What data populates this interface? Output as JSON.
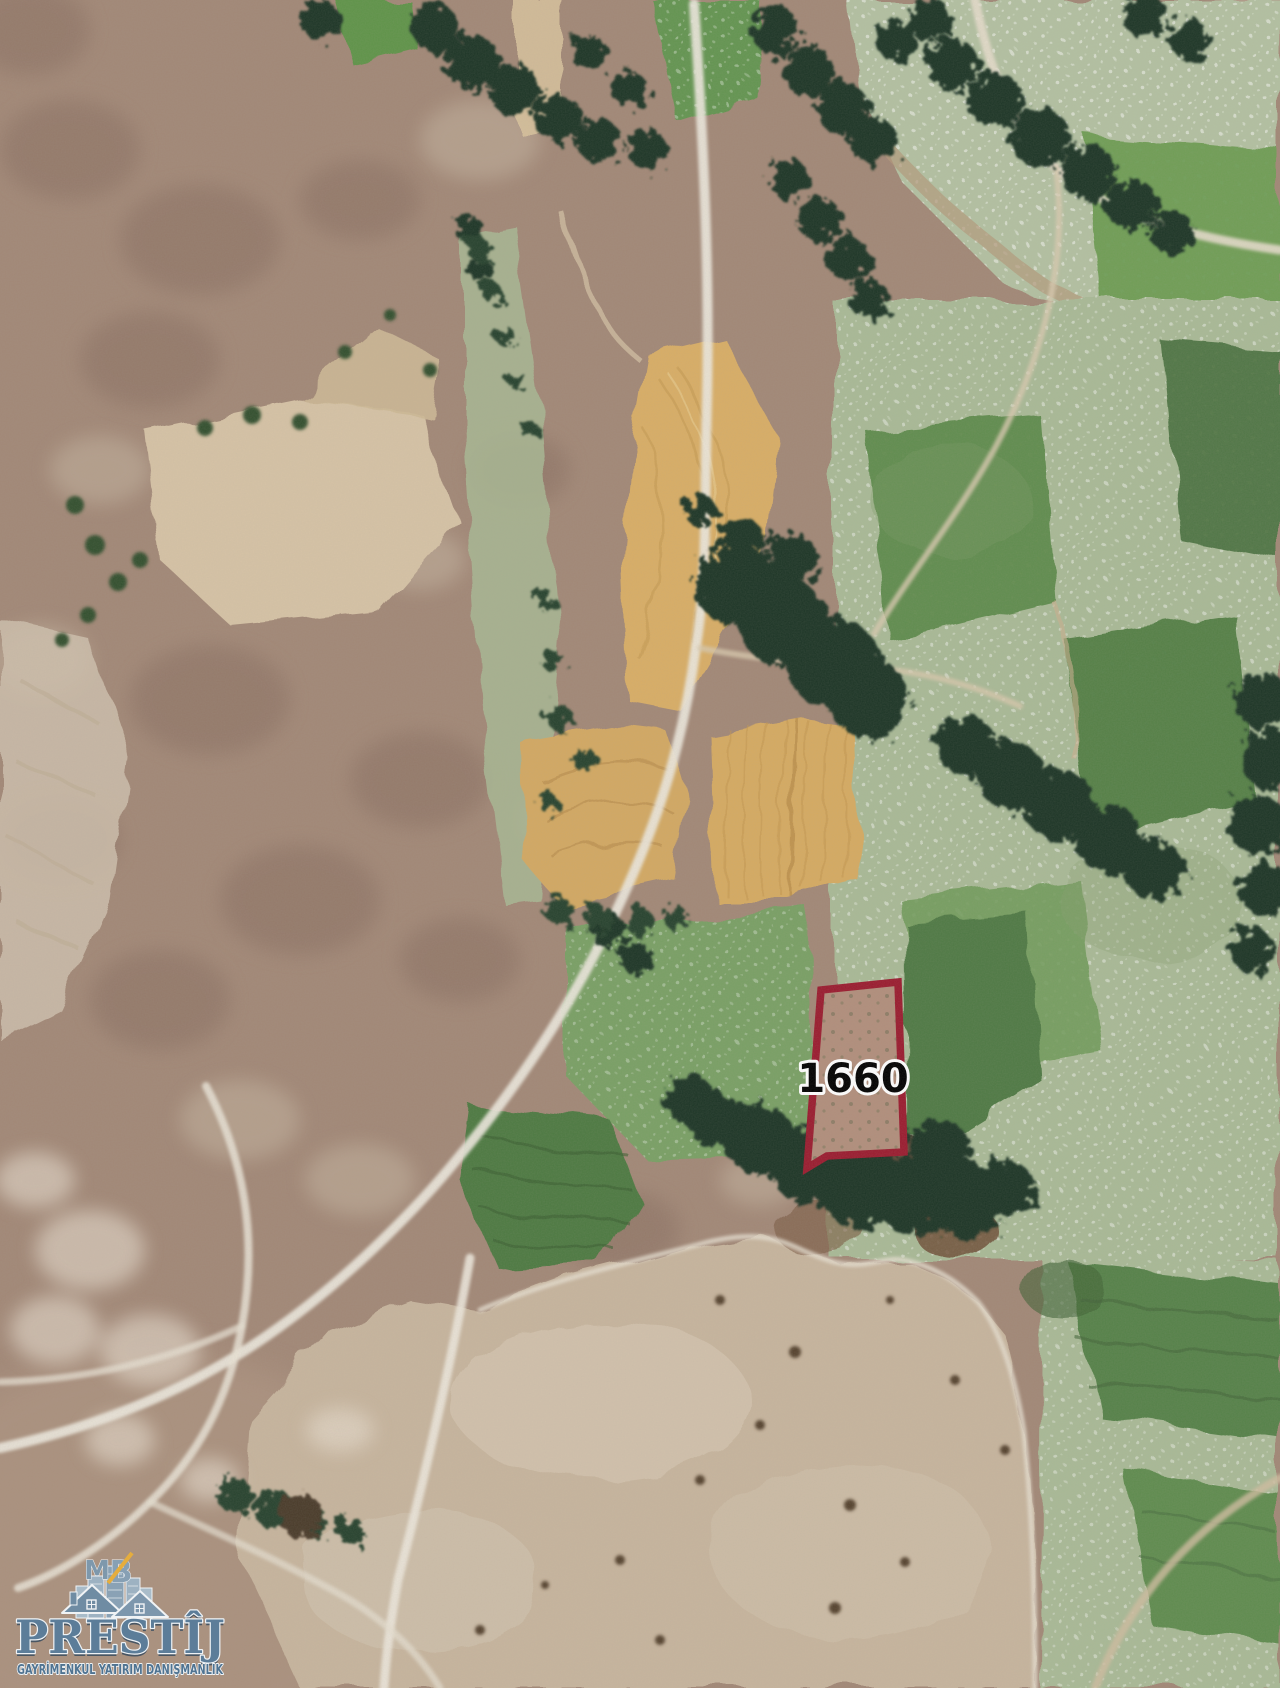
{
  "map": {
    "type": "satellite",
    "parcel": {
      "label": "1660",
      "outline_color": "#9a1b2f",
      "label_color": "#000000",
      "label_outline_color": "#ffffff"
    },
    "palette": {
      "terrain_brown": "#a28877",
      "field_gold": "#d9ae66",
      "field_green": "#5d8a4b",
      "field_sage": "#a9ba97",
      "trees_dark": "#1f3526",
      "road_light": "#ece7dc"
    }
  },
  "watermark": {
    "brand": "PRESTÎJ",
    "monogram_m": "M",
    "monogram_b": "B",
    "tagline": "GAYRİMENKUL YATIRIM DANIŞMANLIK",
    "brand_color": "#5c7d99",
    "accent_color": "#e5ad3d"
  }
}
